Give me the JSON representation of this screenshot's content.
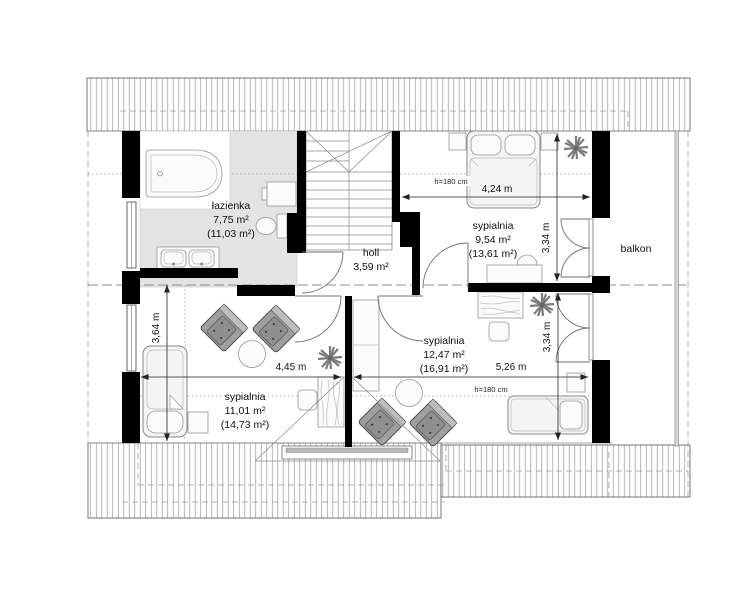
{
  "rooms": {
    "bathroom": {
      "name": "łazienka",
      "area": "7,75 m²",
      "area_gross": "(11,03 m²)"
    },
    "hall": {
      "name": "holl",
      "area": "3,59 m²"
    },
    "bedroom_top": {
      "name": "sypialnia",
      "area": "9,54 m²",
      "area_gross": "(13,61 m²)"
    },
    "bedroom_right": {
      "name": "sypialnia",
      "area": "12,47 m²",
      "area_gross": "(16,91 m²)"
    },
    "bedroom_left": {
      "name": "sypialnia",
      "area": "11,01 m²",
      "area_gross": "(14,73 m²)"
    },
    "balcony": {
      "name": "balkon"
    }
  },
  "dimensions": {
    "bedroom_top_width": "4,24 m",
    "bedroom_top_height": "3,34 m",
    "bedroom_right_width": "5,26 m",
    "bedroom_right_height": "3,34 m",
    "bedroom_left_width": "4,45 m",
    "bedroom_left_height": "3,64 m",
    "headroom_top": "h=180 cm",
    "headroom_bottom": "h=180 cm"
  },
  "colors": {
    "wall": "#000000",
    "bathroom_floor": "#e3e3e3",
    "furniture_fill": "#f5f5f5",
    "armchair_fill": "#9f9f9f",
    "dimension_line": "#222222",
    "guide_line": "#9a9a9a",
    "hatch_line": "#999999"
  }
}
